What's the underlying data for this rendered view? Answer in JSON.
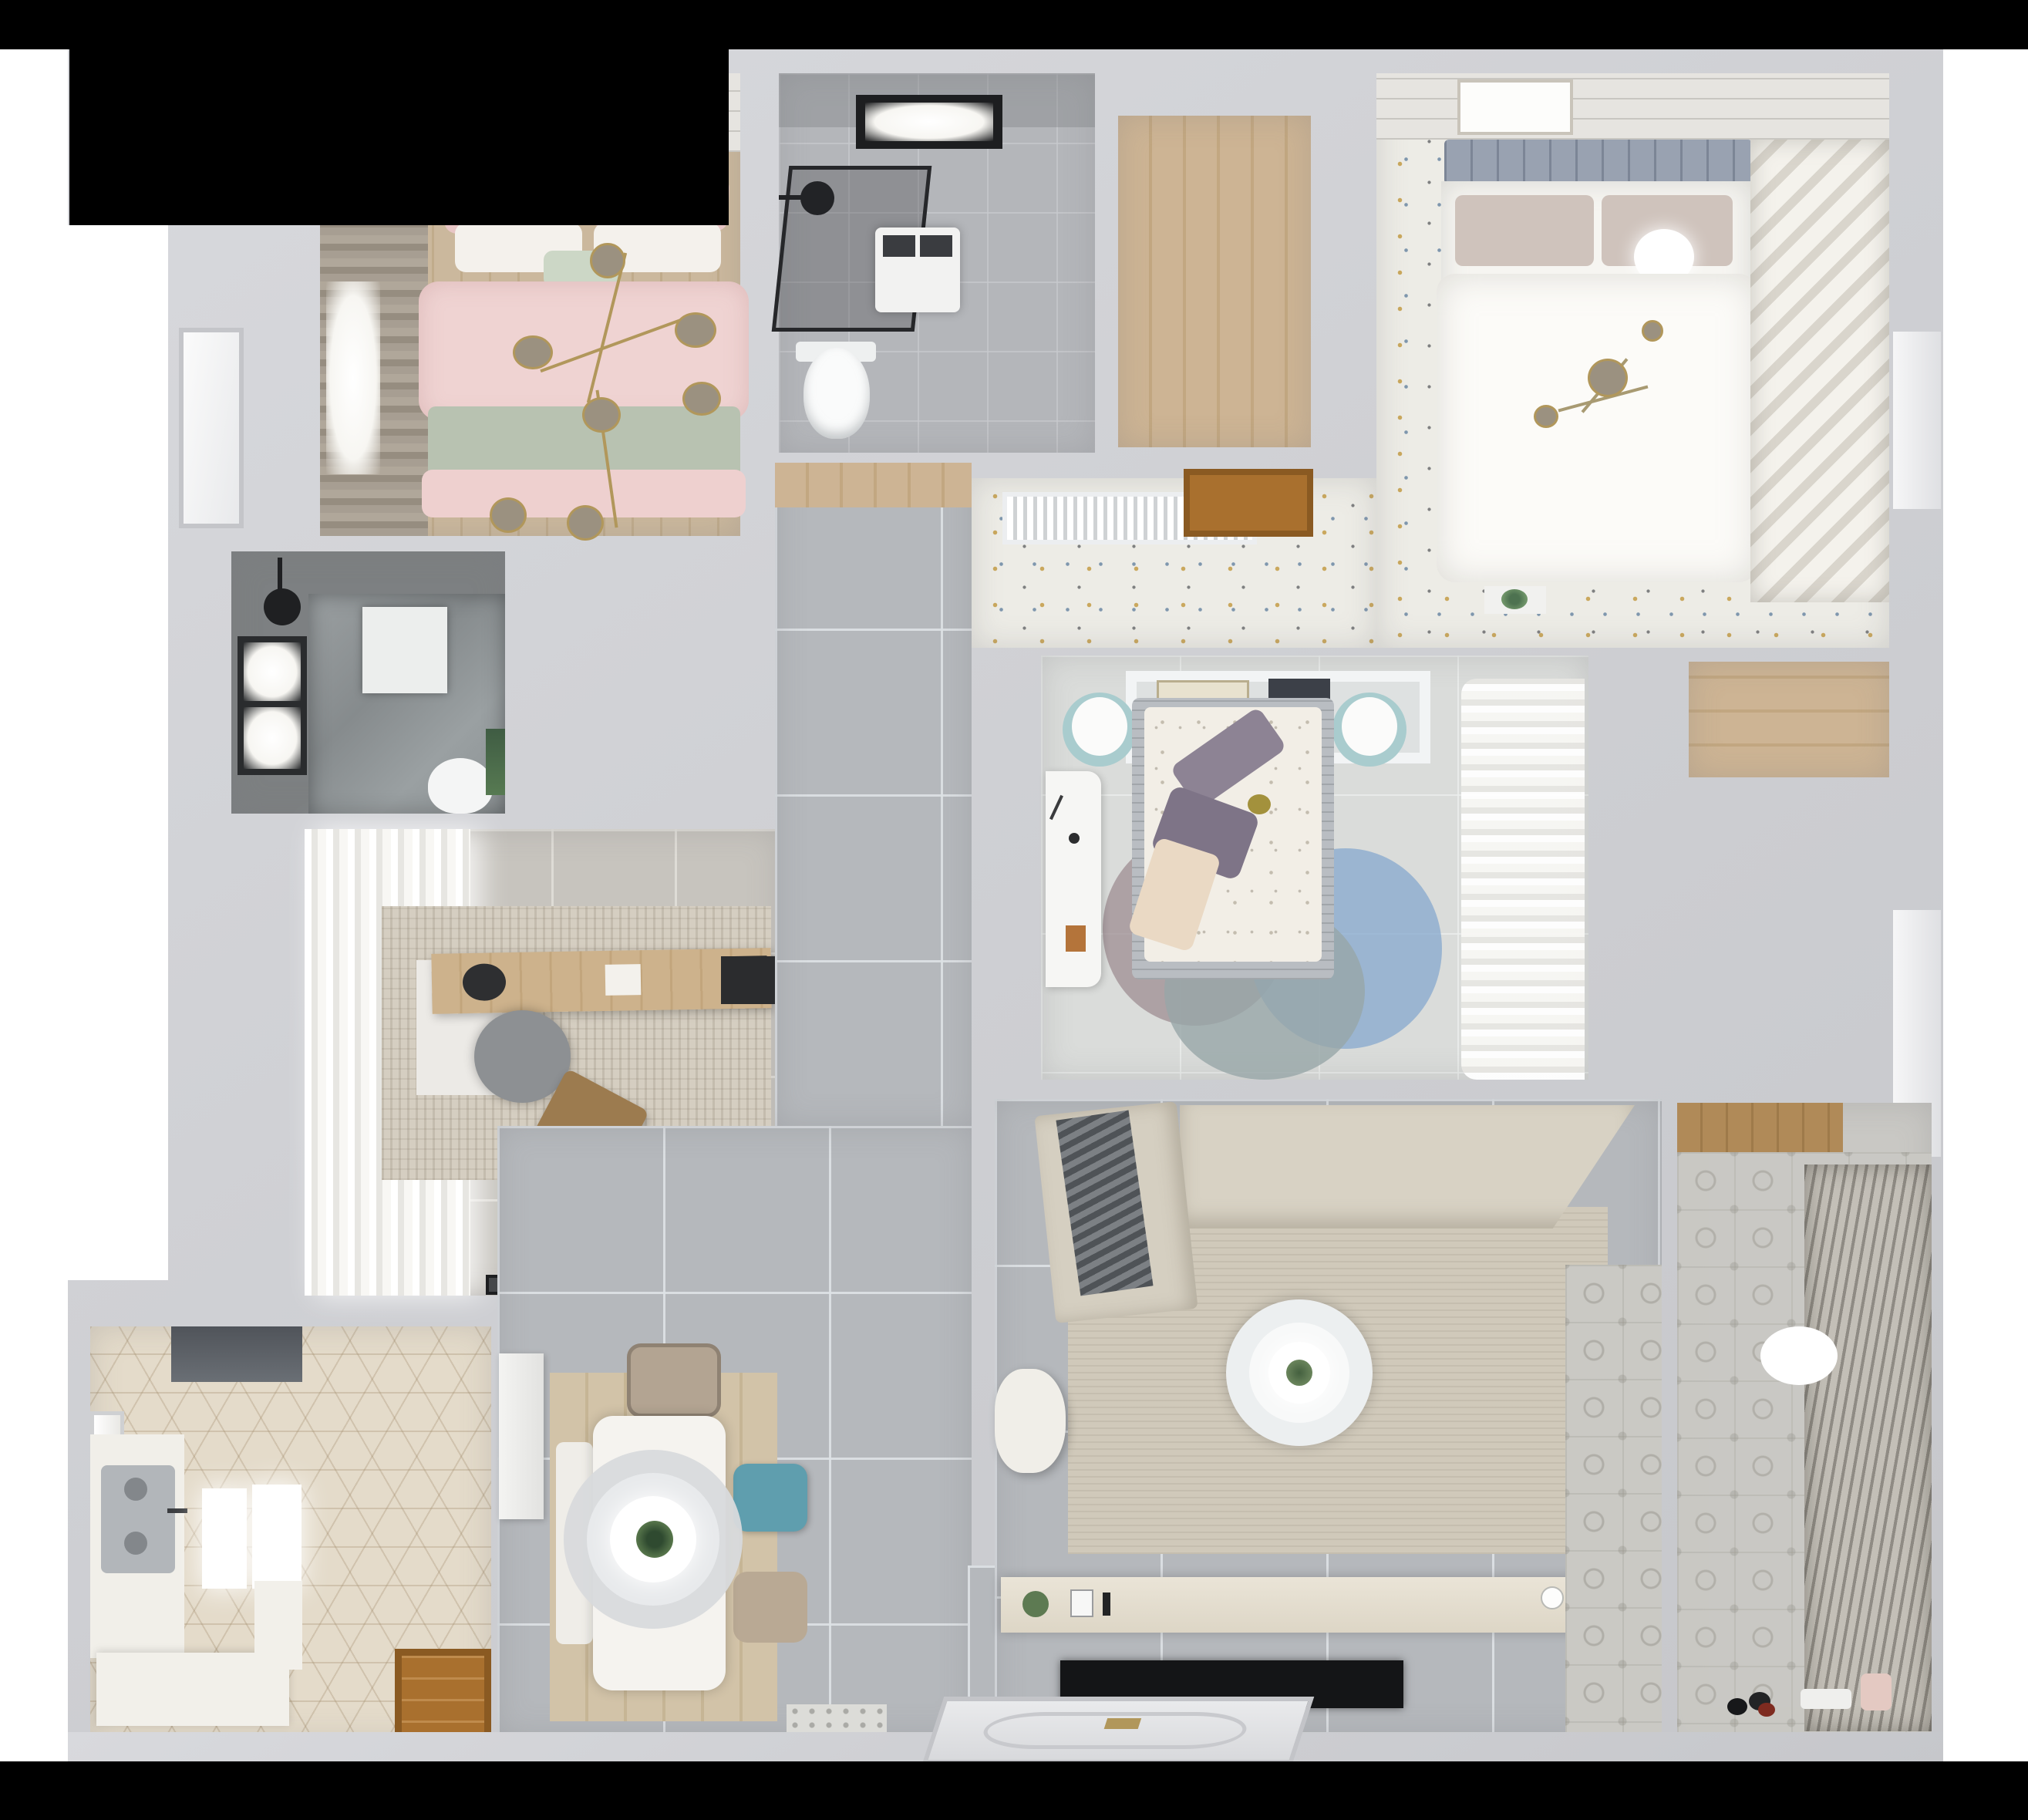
{
  "meta": {
    "title": "Top-down 3D rendered apartment floor plan",
    "view": "bird's-eye / dollhouse render",
    "background": "#ffffff",
    "mask_color": "#000000"
  },
  "palette": {
    "wall": "#cfd0d4",
    "hall_tile": "#b5b8bc",
    "study_tile": "#c7c4be",
    "kitchen_hex": "#e4dbca",
    "wood": "#c9b292",
    "pink_bedding": "#eed2d1",
    "sage_blanket": "#b8c2b1",
    "teal_chair": "#5f9eae",
    "master_speckle_floor": "#edece6",
    "dark_bath": "#7d8082",
    "sofa_beige": "#d8d2c4",
    "rug_beige": "#d0c9ba",
    "tv_black": "#17181a",
    "door_wood": "#a9702e",
    "gold_fixture": "#b1975b"
  },
  "rooms": [
    {
      "id": "bedroom-pink",
      "label": "Bedroom with pink bedding (top left)",
      "furniture": [
        "double-bed",
        "pink-duvet",
        "sage-blanket",
        "pillows",
        "branch-chandelier",
        "art-frames",
        "window-curtain",
        "white-door"
      ]
    },
    {
      "id": "bathroom-top",
      "label": "Bathroom with shower (top center)",
      "furniture": [
        "black-frame-skylight",
        "shower-enclosure",
        "shower-head",
        "washing-machine",
        "toilet"
      ]
    },
    {
      "id": "closet-room",
      "label": "Walk-in closet with wood floor",
      "furniture": [
        "wood-plank-floor",
        "wood-door"
      ]
    },
    {
      "id": "master-bedroom",
      "label": "Master bedroom (top right)",
      "furniture": [
        "double-bed",
        "gray-headboard",
        "white-duvet",
        "taupe-pillows",
        "ceiling-lamp",
        "art-frame",
        "speckled-floor",
        "ac-vent",
        "plant-ledge"
      ]
    },
    {
      "id": "master-closet",
      "label": "Master closet shelving (right strip)",
      "furniture": [
        "diagonal-shelves"
      ]
    },
    {
      "id": "bedroom-center",
      "label": "Bedroom with canopy shelf (center)",
      "furniture": [
        "double-bed",
        "floral-duvet",
        "purple-pillows",
        "canopy-shelf",
        "books",
        "teal-poufs",
        "white-desk",
        "round-rugs",
        "sheer-curtains"
      ]
    },
    {
      "id": "bathroom-dark",
      "label": "Dark tiled shower room (middle left)",
      "furniture": [
        "window",
        "shower-head",
        "shower-tray",
        "toilet",
        "plant"
      ]
    },
    {
      "id": "study",
      "label": "Study / home office",
      "furniture": [
        "white-curtains",
        "desk",
        "laptop",
        "round-chair",
        "lounge-chair",
        "area-rug",
        "wall-shelf",
        "doormat"
      ]
    },
    {
      "id": "hallway",
      "label": "Hallway with large gray tiles",
      "furniture": [
        "gray-floor-tiles",
        "wood-landing"
      ]
    },
    {
      "id": "kitchen",
      "label": "Kitchen with hexagon tiles (bottom left)",
      "furniture": [
        "range-hood",
        "double-sink",
        "counters",
        "ceiling-lights",
        "window",
        "wood-entry-door"
      ]
    },
    {
      "id": "dining",
      "label": "Dining area",
      "furniture": [
        "white-table",
        "ring-pendant-lamp",
        "plant-centerpiece",
        "teal-chair",
        "beige-chairs",
        "bench",
        "wood-rug",
        "tall-cabinet",
        "entry-mat"
      ]
    },
    {
      "id": "living",
      "label": "Living room",
      "furniture": [
        "sectional-sofa",
        "gray-throw",
        "area-rug",
        "round-coffee-table",
        "armchair",
        "tv-console",
        "flat-tv",
        "patterned-threshold"
      ]
    },
    {
      "id": "balcony",
      "label": "Balcony / laundry (bottom right)",
      "furniture": [
        "patterned-tile-floor",
        "louver-blinds",
        "wood-counter",
        "oval-mat",
        "toys",
        "baskets"
      ]
    },
    {
      "id": "entry",
      "label": "Entry with decorative door panel",
      "furniture": [
        "paneled-door",
        "gold-handle"
      ]
    }
  ]
}
